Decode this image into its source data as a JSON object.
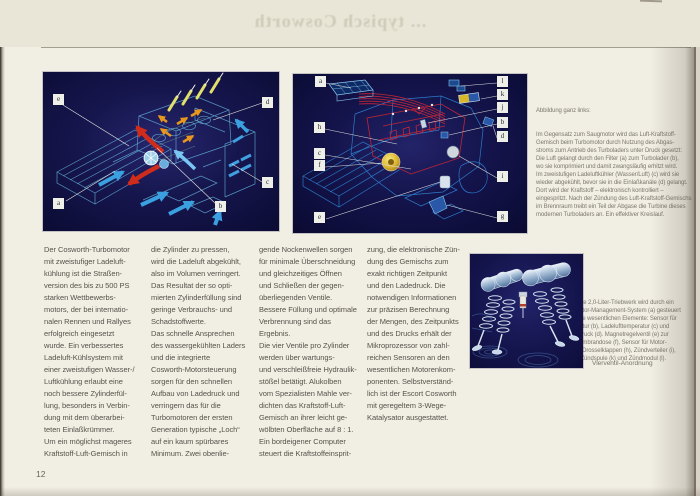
{
  "page": {
    "number": "12",
    "bleed_title": "... typisch Cosworth"
  },
  "body": {
    "col1": "Der Cosworth-Turbomotor\nmit zweistufiger Ladeluft-\nkühlung ist die Straßen-\nversion des bis zu 500 PS\nstarken Wettbewerbs-\nmotors, der bei internatio-\nnalen Rennen und Rallyes\nerfolgreich eingesetzt\nwurde. Ein verbessertes\nLadeluft-Kühlsystem mit\neiner zweistufigen Wasser-/\nLuftkühlung erlaubt eine\nnoch bessere Zylinderfül-\nlung, besonders in Verbin-\ndung mit dem überarbei-\nteten Einlaßkrümmer.\nUm ein möglichst mageres\nKraftstoff-Luft-Gemisch in",
    "col2": "die Zylinder zu pressen,\nwird die Ladeluft abgekühlt,\nalso im Volumen verringert.\nDas Resultat der so opti-\nmierten Zylinderfüllung sind\ngeringe Verbrauchs- und\nSchadstoffwerte.\nDas schnelle Ansprechen\ndes wassergekühlten Laders\nund die integrierte\nCosworth-Motorsteuerung\nsorgen für den schnellen\nAufbau von Ladedruck und\nverringern das für die\nTurbomotoren der ersten\nGeneration typische „Loch“\nauf ein kaum spürbares\nMinimum. Zwei obenlie-",
    "col3": "gende Nockenwellen sorgen\nfür minimale Überschneidung\nund gleichzeitiges Öffnen\nund Schließen der gegen-\nüberliegenden Ventile.\nBessere Füllung und optimale\nVerbrennung sind das\nErgebnis.\nDie vier Ventile pro Zylinder\nwerden über wartungs-\nund verschleißfreie Hydraulik-\nstößel betätigt. Alukolben\nvom Spezialisten Mahle ver-\ndichten das Kraftstoff-Luft-\nGemisch an ihrer leicht ge-\nwölbten Oberfläche auf 8 : 1.\nEin bordeigener Computer\nsteuert die Kraftstoffeinsprit-",
    "col4": "zung, die elektronische Zün-\ndung des Gemischs zum\nexakt richtigen Zeitpunkt\nund den Ladedruck. Die\nnotwendigen Informationen\nzur präzisen Berechnung\nder Mengen, des Zeitpunkts\nund des Drucks erhält der\nMikroprozessor von zahl-\nreichen Sensoren an den\nwesentlichen Motorenkom-\nponenten. Selbstverständ-\nlich ist der Escort Cosworth\nmit geregeltem 3-Wege-\nKatalysator ausgestattet."
  },
  "captions": {
    "caption1_title": "Abbildung ganz links:",
    "caption1_body": "Im Gegensatz zum Saugmotor wird das Luft-Kraftstoff-\nGemisch beim Turbomotor durch Nutzung des Abgas-\nstroms zum Antrieb des Turboladers unter Druck gesetzt:\nDie Luft gelangt durch den Filter (a) zum Turbolader (b),\nwo sie komprimiert und damit zwangsläufig erhitzt wird.\nIm zweistufigen Ladeluftkühler (Wasser/Luft) (c) wird sie\nwieder abgekühlt, bevor sie in die Einlaßkanäle (d) gelangt.\nDort wird der Kraftstoff – elektronisch kontrolliert –\neingespritzt. Nach der Zündung des Luft-Kraftstoff-Gemischs\nim Brennraum treibt ein Teil der Abgase die Turbine dieses\nmodernen Turboladers an. Ein effektiver Kreislauf.",
    "caption2_title": "Abbildung links:",
    "caption2_body": "Das leistungsstarke 2,0-Liter-Triebwerk wird durch ein\nhocheffektives Motor-Management-System (a) gesteuert\nund kontrolliert. Die wesentlichen Elemente: Sensor für\nKühlmitteltemperatur (b), Ladelufttemperatur (c) und\nUnterdruck/Ladedruck (d). Magnetregelventil (e) zur\nSteuerung der Membrandose (f), Sensor für Motor-\ndrehzahl/O.T. (g), Drosselklappen (h), Zündverteiler (i),\nEinspritzdüse (j), Zündspule (k) und Zündmodul (l)."
  },
  "figures": {
    "fig1": {
      "labels": {
        "a": "a",
        "b": "b",
        "c": "c",
        "d": "d",
        "e": "e"
      }
    },
    "fig2": {
      "labels": {
        "a": "a",
        "b": "b",
        "c": "c",
        "d": "d",
        "e": "e",
        "f": "f",
        "g": "g",
        "h": "h",
        "i": "i",
        "j": "j",
        "k": "k",
        "l": "l"
      }
    },
    "fig3": {
      "caption": "Vierventil-Anordnung"
    }
  },
  "colors": {
    "page_bg": "#f1eee4",
    "figure_bg": "#14144e",
    "wireframe_blue": "#5fa8d6",
    "arrow_red": "#cf2c1c",
    "arrow_orange": "#e8971e",
    "arrow_blue": "#3aa0e0",
    "accent_yellow": "#e0d44a",
    "body_text": "#56534b",
    "caption_text": "#7c786d"
  }
}
